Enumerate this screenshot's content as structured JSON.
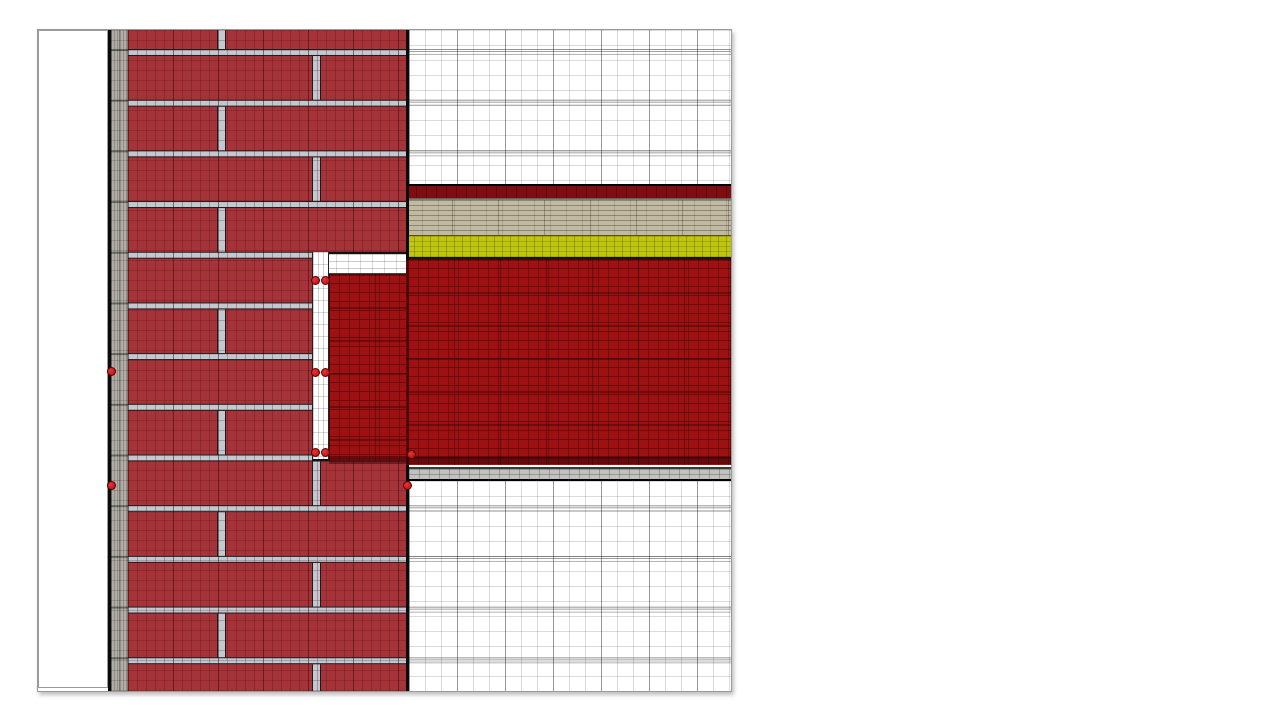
{
  "page": {
    "background": "#ffffff"
  },
  "drawing": {
    "kind": "construction-detail-with-fem-mesh",
    "description_visible": "",
    "regions": [
      {
        "name": "exterior-air",
        "color": "#ffffff"
      },
      {
        "name": "exterior-surface-line",
        "color": "#0a0a0a"
      },
      {
        "name": "exterior-render",
        "color": "#b1ada4"
      },
      {
        "name": "brick-masonry",
        "color": "#a5333a"
      },
      {
        "name": "mortar-joint",
        "color": "#c3c7d0"
      },
      {
        "name": "interior-space-upper",
        "color": "#ffffff"
      },
      {
        "name": "floor-finish",
        "color": "#7e0d11"
      },
      {
        "name": "screed",
        "color": "#c2b9a1"
      },
      {
        "name": "insulation",
        "color": "#bfc60d"
      },
      {
        "name": "concrete-slab",
        "color": "#9d1113"
      },
      {
        "name": "cavity-air-gap",
        "color": "#ffffff"
      },
      {
        "name": "ceiling-plaster",
        "color": "#c1c1bf"
      },
      {
        "name": "interior-space-lower",
        "color": "#ffffff"
      }
    ],
    "node_markers": {
      "color": "#d01216",
      "count": 10,
      "positions": [
        {
          "style": "left:69px;top:337px"
        },
        {
          "style": "left:69px;top:451px"
        },
        {
          "style": "left:273px;top:246px"
        },
        {
          "style": "left:283px;top:246px"
        },
        {
          "style": "left:273px;top:338px"
        },
        {
          "style": "left:283px;top:338px"
        },
        {
          "style": "left:273px;top:418px"
        },
        {
          "style": "left:283px;top:418px"
        },
        {
          "style": "left:369px;top:420px"
        },
        {
          "style": "left:365px;top:451px"
        }
      ]
    }
  }
}
